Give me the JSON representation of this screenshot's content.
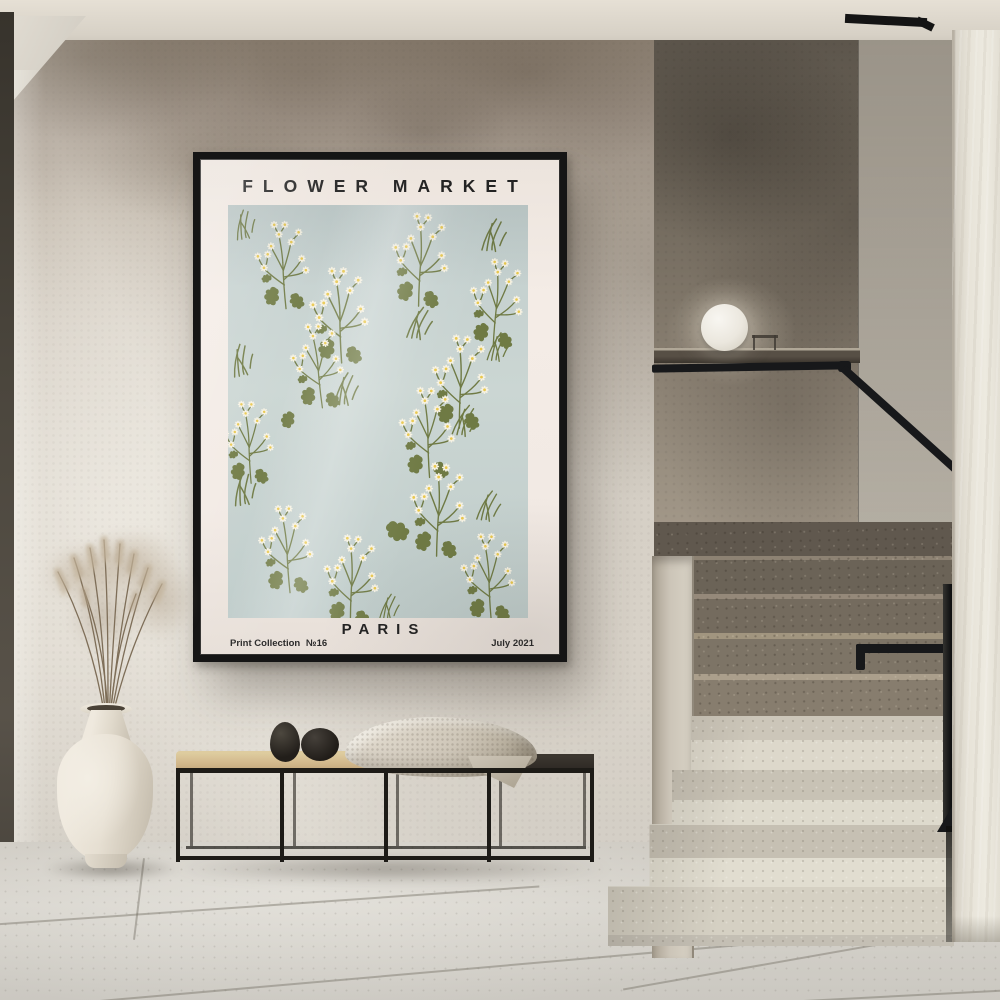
{
  "poster": {
    "title": "FLOWER MARKET",
    "city": "PARIS",
    "collection_label": "Print Collection",
    "collection_number": "№16",
    "date": "July 2021",
    "colors": {
      "frame": "#151515",
      "mat": "#f2eae4",
      "panel": "#c6d1cf",
      "stem_green": "#6f7a44",
      "petal_white": "#f6f2e3",
      "daisy_center": "#e9c84e",
      "text": "#232323"
    },
    "pattern": {
      "sprigs": [
        {
          "x": 22,
          "y": 14,
          "s": 0.66,
          "r": -4
        },
        {
          "x": 158,
          "y": 6,
          "s": 0.7,
          "r": 3
        },
        {
          "x": 76,
          "y": 60,
          "s": 0.72,
          "r": -2
        },
        {
          "x": 236,
          "y": 52,
          "s": 0.66,
          "r": 5
        },
        {
          "x": 58,
          "y": 116,
          "s": 0.64,
          "r": -6
        },
        {
          "x": 198,
          "y": 128,
          "s": 0.7,
          "r": 2
        },
        {
          "x": -10,
          "y": 194,
          "s": 0.62,
          "r": -3
        },
        {
          "x": 166,
          "y": 180,
          "s": 0.68,
          "r": -2
        },
        {
          "x": 176,
          "y": 256,
          "s": 0.7,
          "r": 3
        },
        {
          "x": 26,
          "y": 298,
          "s": 0.66,
          "r": -4
        },
        {
          "x": 90,
          "y": 328,
          "s": 0.68,
          "r": 2
        },
        {
          "x": 228,
          "y": 326,
          "s": 0.66,
          "r": -3
        }
      ],
      "grass": [
        {
          "x": 4,
          "y": 2,
          "s": 0.55,
          "r": -8
        },
        {
          "x": 252,
          "y": 10,
          "s": 0.62,
          "r": 6
        },
        {
          "x": 178,
          "y": 98,
          "s": 0.62,
          "r": 10
        },
        {
          "x": 258,
          "y": 124,
          "s": 0.55,
          "r": 8
        },
        {
          "x": 0,
          "y": 136,
          "s": 0.6,
          "r": -10
        },
        {
          "x": 104,
          "y": 164,
          "s": 0.62,
          "r": 4
        },
        {
          "x": 224,
          "y": 196,
          "s": 0.6,
          "r": 12
        },
        {
          "x": 2,
          "y": 264,
          "s": 0.62,
          "r": -6
        },
        {
          "x": 248,
          "y": 282,
          "s": 0.58,
          "r": 10
        },
        {
          "x": 150,
          "y": 386,
          "s": 0.5,
          "r": 6
        }
      ],
      "loose_leaves": [
        {
          "x": 170,
          "y": 316,
          "s": 0.85,
          "r": -50
        },
        {
          "x": 60,
          "y": 208,
          "s": 0.6,
          "r": 30
        }
      ]
    }
  },
  "scene": {
    "colors": {
      "wall_plaster": "#d5cfc5",
      "wall_upper_shade": "#8e8274",
      "stairwell_wall": "#6c6458",
      "ceiling": "#d7d1c6",
      "floor_tile": "#d2cfc8",
      "column": "#e7e3d8",
      "steps_upper_terrazzo": "#8d8274",
      "steps_lower_terrazzo": "#d9d4c7",
      "handrail_black": "#17181a",
      "bench_frame": "#1d1b17",
      "bench_cushion": "#d2b88c",
      "bench_dark_top": "#2c2823",
      "throw_knit": "#cfc7b9",
      "vase_cream": "#efe9de",
      "pampas": "#b6a48b",
      "lamp_sphere": "#f1ede4",
      "door_edge": "#4b463d"
    }
  }
}
